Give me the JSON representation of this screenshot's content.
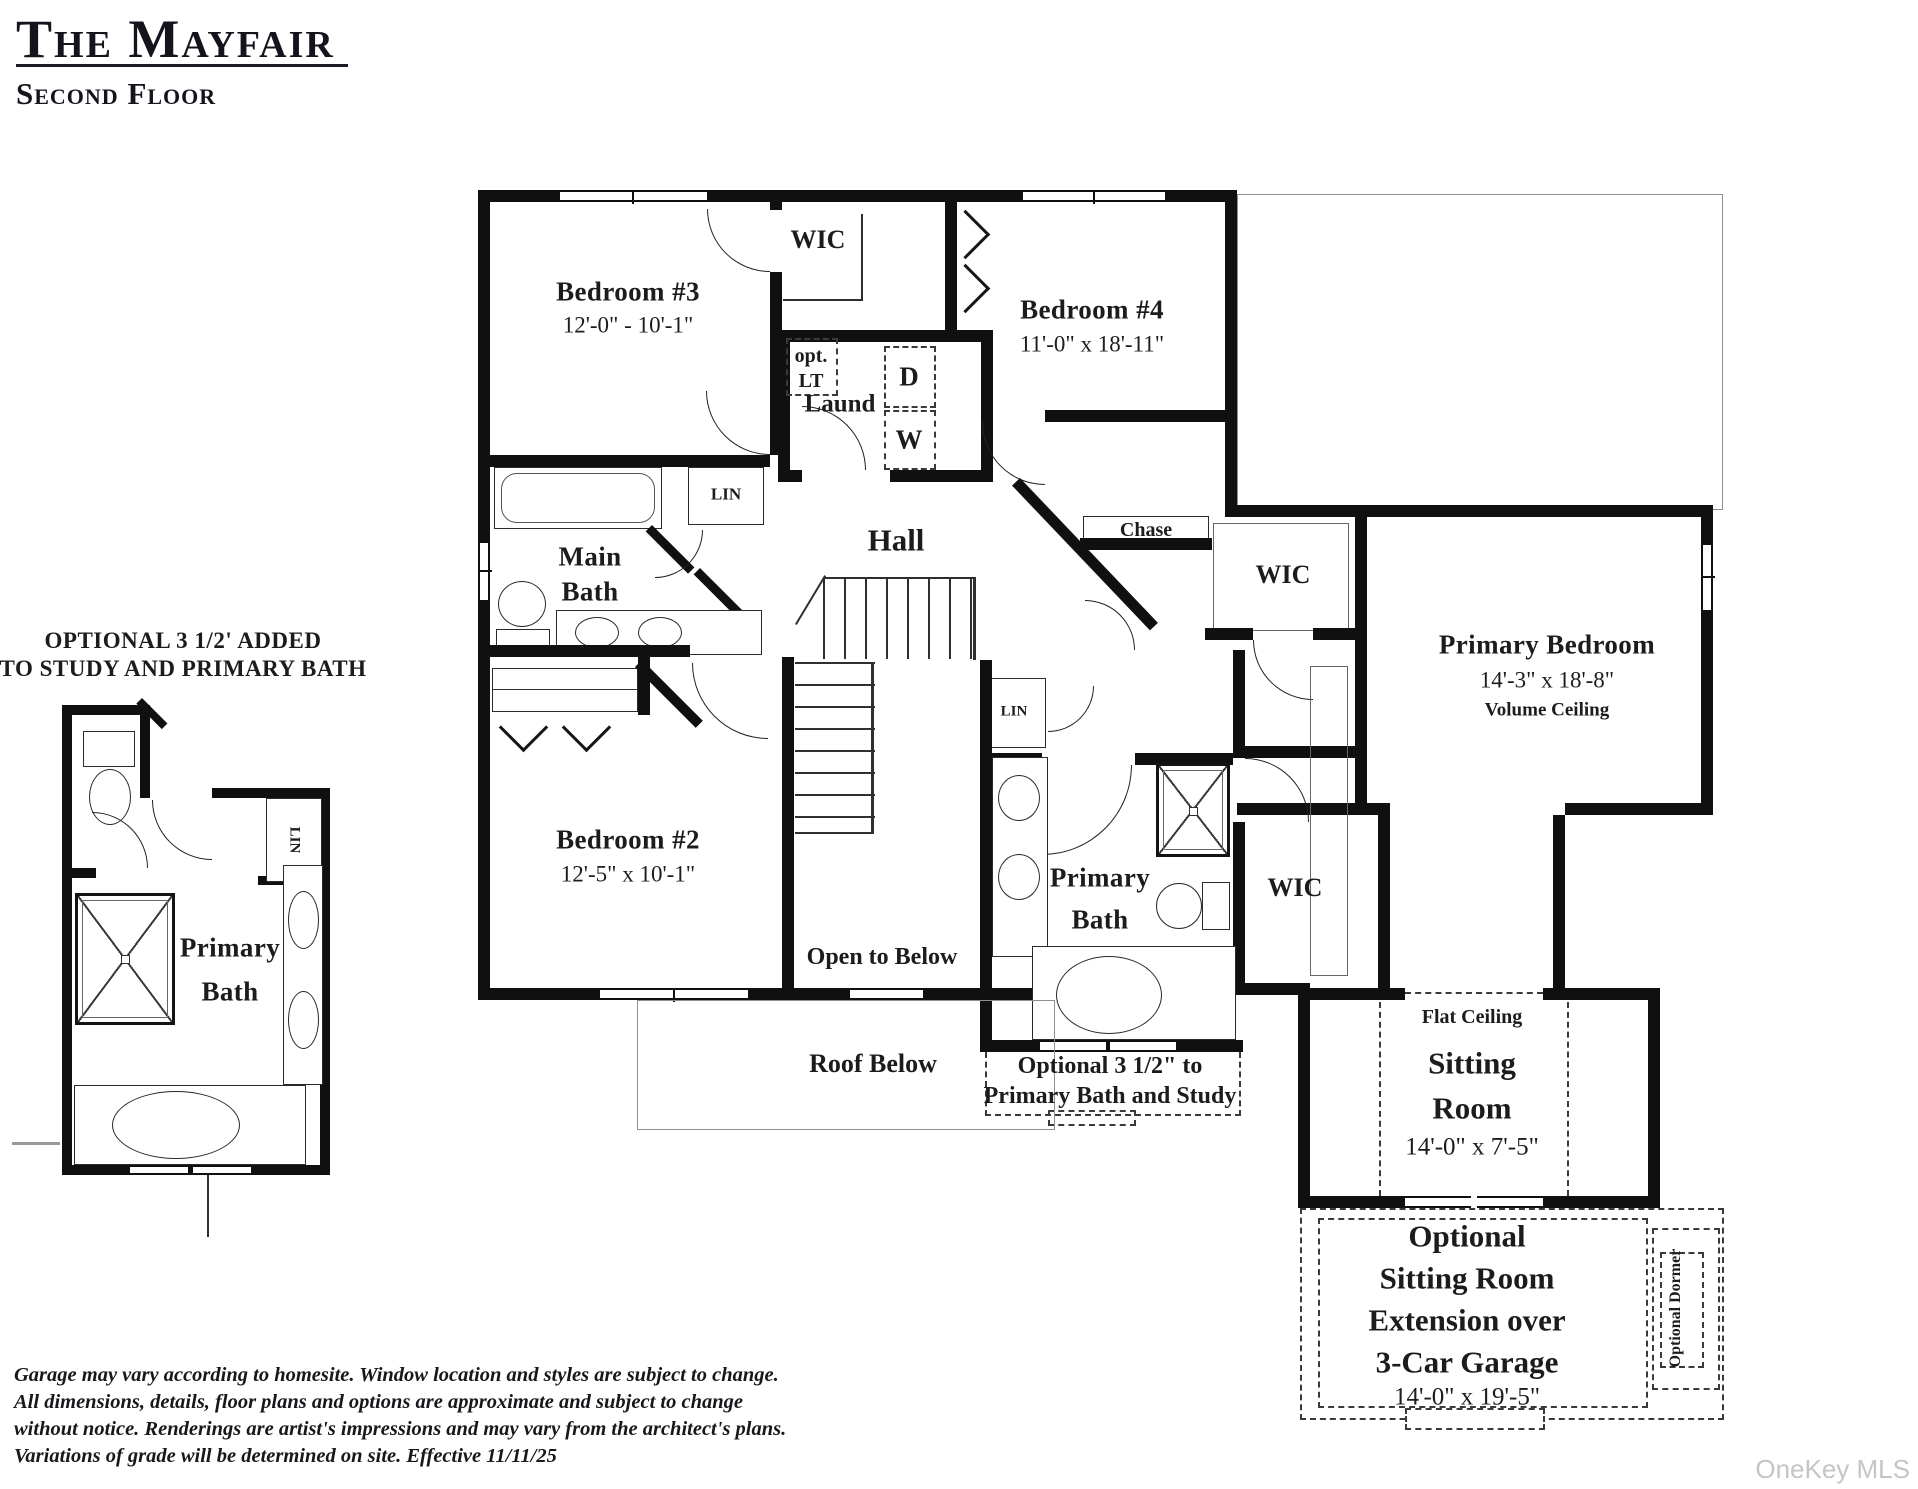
{
  "header": {
    "title": "The Mayfair",
    "subtitle": "Second Floor"
  },
  "inset": {
    "caption1": "OPTIONAL 3 1/2' ADDED",
    "caption2": "TO STUDY AND PRIMARY BATH",
    "bath1": "Primary",
    "bath2": "Bath",
    "lin": "LIN"
  },
  "plan": {
    "bedroom3_name": "Bedroom #3",
    "bedroom3_dims": "12'-0\" - 10'-1\"",
    "bedroom4_name": "Bedroom #4",
    "bedroom4_dims": "11'-0\" x 18'-11\"",
    "bedroom2_name": "Bedroom #2",
    "bedroom2_dims": "12'-5\" x 10'-1\"",
    "primary_bedroom_name": "Primary Bedroom",
    "primary_bedroom_dims": "14'-3\" x 18'-8\"",
    "primary_bedroom_note": "Volume Ceiling",
    "wic_top": "WIC",
    "wic_right": "WIC",
    "wic_bottom": "WIC",
    "laund": "Laund",
    "opt1": "opt.",
    "opt2": "LT",
    "dryer": "D",
    "washer": "W",
    "hall": "Hall",
    "chase": "Chase",
    "lin_bath": "LIN",
    "lin_hall": "LIN",
    "main_bath1": "Main",
    "main_bath2": "Bath",
    "primary_bath1": "Primary",
    "primary_bath2": "Bath",
    "open_below": "Open to Below",
    "roof_below": "Roof Below",
    "opt_bath1": "Optional 3 1/2\" to",
    "opt_bath2": "Primary Bath and Study",
    "flat_ceiling": "Flat Ceiling",
    "sitting1": "Sitting",
    "sitting2": "Room",
    "sitting_dims": "14'-0\" x 7'-5\"",
    "ext1": "Optional",
    "ext2": "Sitting Room",
    "ext3": "Extension over",
    "ext4": "3-Car Garage",
    "ext_dims": "14'-0\" x 19'-5\"",
    "dormer": "Optional Dormer"
  },
  "disclaimer": {
    "line1": "Garage may vary according to homesite.   Window location and styles are subject to change.",
    "line2": "All dimensions, details, floor plans and options are approximate and subject to change",
    "line3": "without notice.   Renderings are artist's impressions and may vary from the architect's plans.",
    "line4": "Variations of grade will be determined on site.  Effective 11/11/25"
  },
  "watermark": "OneKey MLS",
  "colors": {
    "wall": "#101010",
    "text": "#1c1c1c",
    "watermark": "#c5c5c5"
  }
}
